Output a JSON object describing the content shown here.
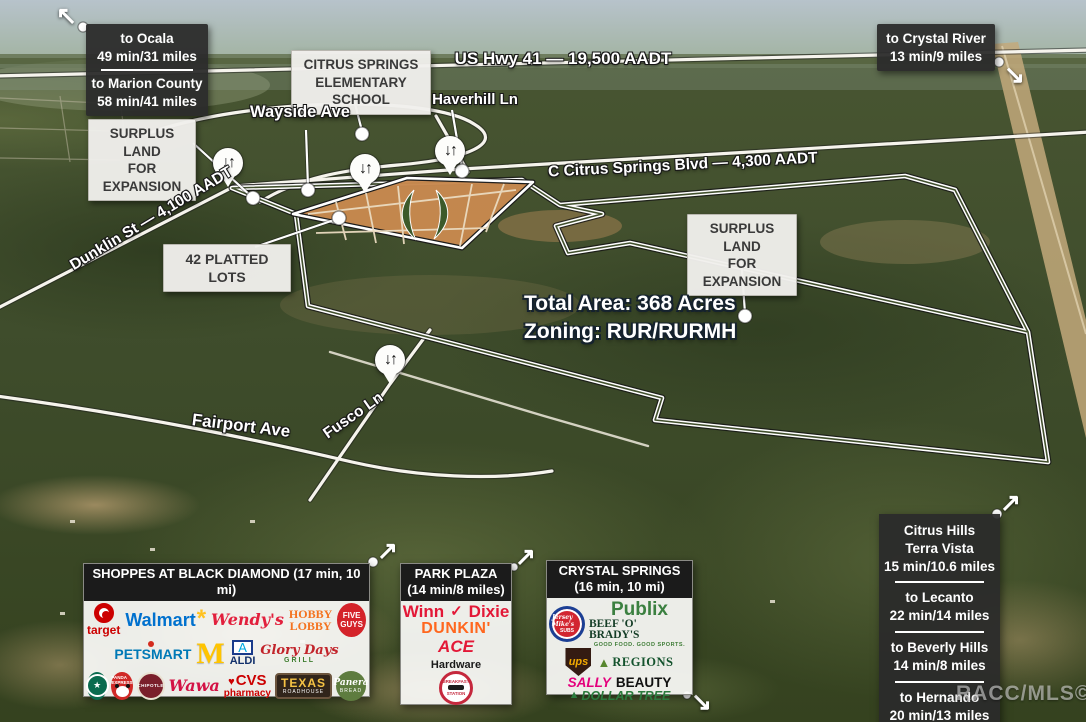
{
  "watermark": "RACC/MLS©",
  "icons": {
    "arrow_up_left": "↖",
    "arrow_up_right": "↗",
    "arrow_down_right": "↘",
    "pin_arrows": "↓↑",
    "star": "★",
    "heart": "♥",
    "check": "✓",
    "spark": "*",
    "tree": "▲",
    "aldi_a": "A"
  },
  "colors": {
    "dark_box_bg": "#2b2b2b",
    "light_box_bg": "#efeeec",
    "panel_header_bg": "#1b1b1b",
    "boundary_line": "#ffffff",
    "platted_lots_fill": "#c8894f",
    "road_line": "#f6f4ed"
  },
  "roads": {
    "us41": "US Hwy 41 — 19,500 AADT",
    "wayside": "Wayside Ave",
    "haverhill": "Haverhill Ln",
    "citrus_blvd": "C Citrus Springs Blvd — 4,300 AADT",
    "dunklin": "Dunklin St — 4,100 AADT",
    "fairport": "Fairport Ave",
    "fusco": "Fusco Ln"
  },
  "callouts": {
    "ocala": {
      "l1": "to Ocala",
      "l2": "49 min/31 miles",
      "l3": "to Marion County",
      "l4": "58 min/41 miles"
    },
    "crystal_river": {
      "l1": "to Crystal River",
      "l2": "13 min/9 miles"
    },
    "school": {
      "l1": "CITRUS SPRINGS",
      "l2": "ELEMENTARY SCHOOL"
    },
    "surplus": {
      "l1": "SURPLUS LAND",
      "l2": "FOR EXPANSION"
    },
    "platted_lots": "42 PLATTED LOTS",
    "area": {
      "l1": "Total Area: 368 Acres",
      "l2": "Zoning: RUR/RURMH"
    }
  },
  "destinations": [
    {
      "name": "Citrus Hills",
      "name2": "Terra Vista",
      "time": "15 min/10.6 miles"
    },
    {
      "name": "to Lecanto",
      "time": "22 min/14 miles"
    },
    {
      "name": "to Beverly Hills",
      "time": "14 min/8 miles"
    },
    {
      "name": "to Hernando",
      "time": "20 min/13 miles"
    }
  ],
  "panels": {
    "black_diamond": {
      "title": "SHOPPES AT BLACK DIAMOND (17 min, 10 mi)"
    },
    "park_plaza": {
      "title": "PARK PLAZA",
      "subtitle": "(14 min/8 miles)"
    },
    "crystal_springs": {
      "title": "CRYSTAL SPRINGS",
      "subtitle": "(16 min, 10 mi)"
    }
  },
  "brands": {
    "target": "target",
    "walmart": "Walmart",
    "petsmart": "PETSMART",
    "wendys": "Wendy's",
    "hobby1": "HOBBY",
    "hobby2": "LOBBY",
    "five1": "FIVE",
    "five2": "GUYS",
    "mcdonalds": "M",
    "aldi": "ALDI",
    "glory1": "Glory Days",
    "glory2": "GRILL",
    "panda1": "PANDA EXPRESS",
    "chipotle": "CHIPOTLE",
    "wawa": "Wawa",
    "cvs1": "CVS",
    "cvs2": "pharmacy",
    "texas1": "TEXAS",
    "texas2": "ROADHOUSE",
    "panera1": "Panera",
    "panera2": "BREAD",
    "winn1": "Winn",
    "winn2": "Dixie",
    "dunkin": "DUNKIN'",
    "ace1": "ACE",
    "ace2": "Hardware",
    "breakfast1": "BREAKFAST",
    "breakfast2": "STATION",
    "jersey1": "Jersey Mike's",
    "jersey2": "SUBS",
    "publix": "Publix",
    "beef": "BEEF 'O' BRADY'S",
    "beef_tag": "GOOD FOOD. GOOD SPORTS.",
    "ups": "ups",
    "regions": "REGIONS",
    "sally1": "SALLY",
    "sally2": "BEAUTY",
    "dollar": "DOLLAR TREE"
  }
}
